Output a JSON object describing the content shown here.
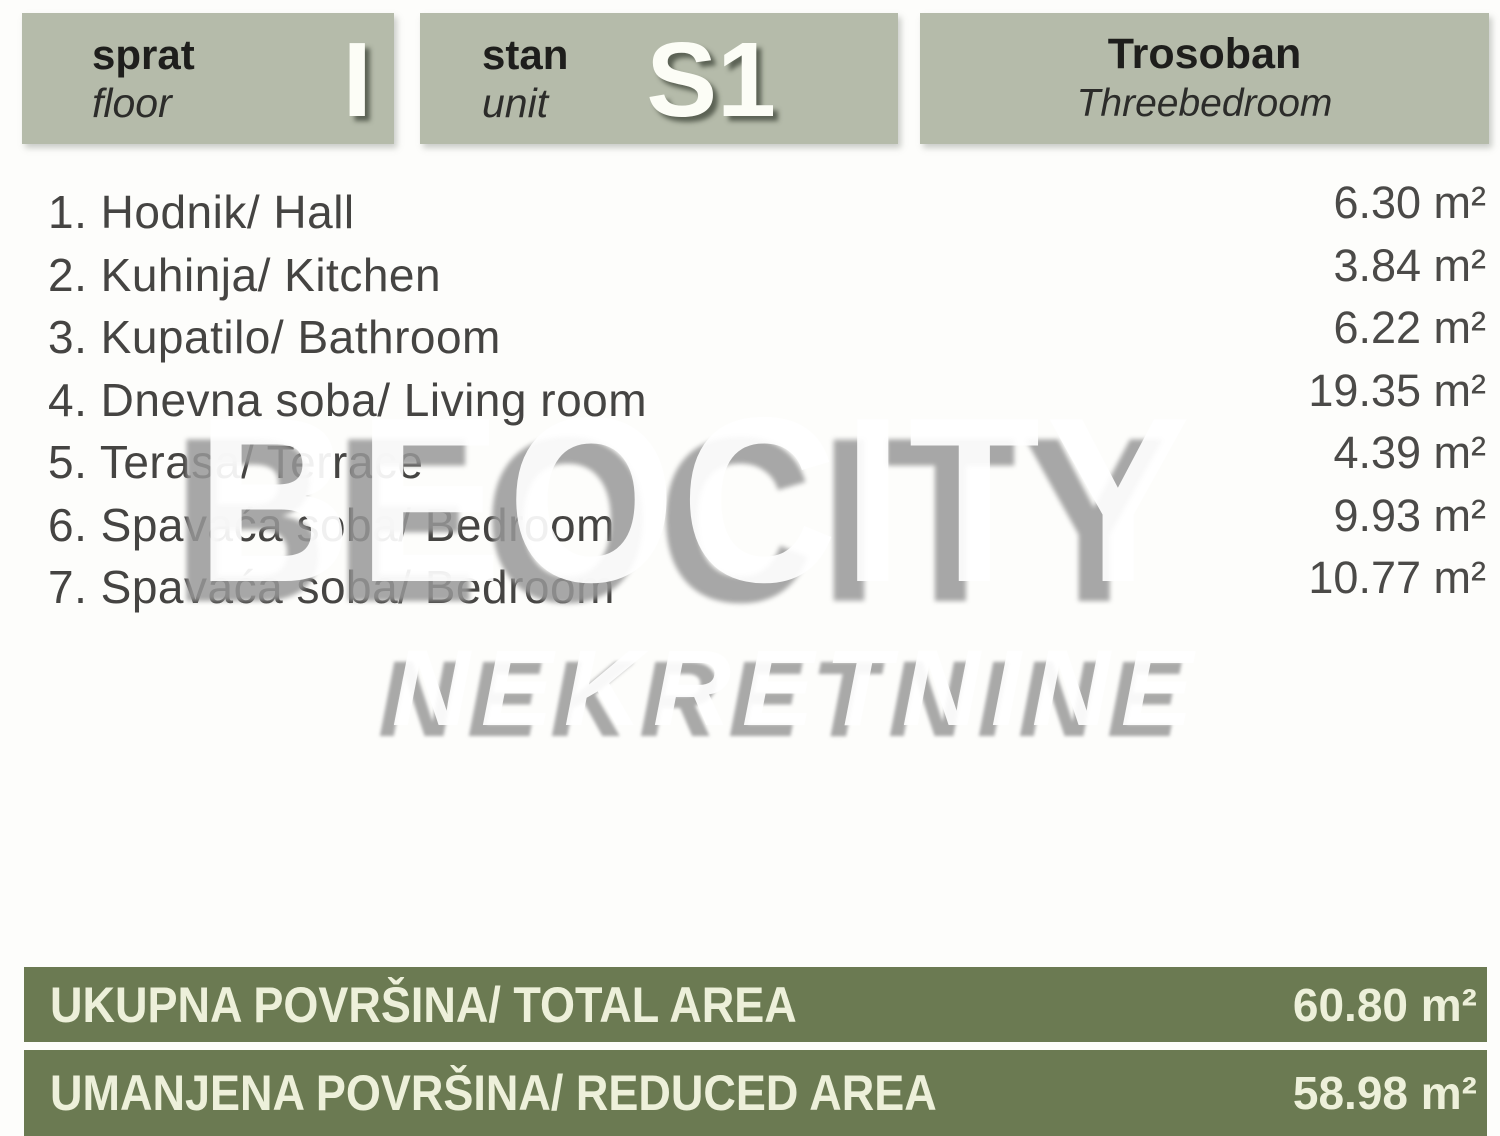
{
  "header": {
    "floor": {
      "label": "sprat",
      "sublabel": "floor",
      "value": "I"
    },
    "unit": {
      "label": "stan",
      "sublabel": "unit",
      "value": "S1"
    },
    "apartment_type": {
      "label": "Trosoban",
      "sublabel": "Threebedroom"
    }
  },
  "rooms": [
    {
      "label": "1. Hodnik/ Hall",
      "area": "6.30 m²"
    },
    {
      "label": "2. Kuhinja/ Kitchen",
      "area": "3.84 m²"
    },
    {
      "label": "3. Kupatilo/ Bathroom",
      "area": "6.22 m²"
    },
    {
      "label": "4. Dnevna soba/ Living room",
      "area": "19.35 m²"
    },
    {
      "label": "5. Terasa/ Terrace",
      "area": "4.39 m²"
    },
    {
      "label": "6. Spavaća soba/ Bedroom",
      "area": "9.93 m²"
    },
    {
      "label": "7. Spavaća soba/ Bedroom",
      "area": "10.77 m²"
    }
  ],
  "watermark": {
    "primary": "BEOCITY",
    "secondary": "NEKRETNINE"
  },
  "totals": {
    "total": {
      "label": "UKUPNA POVRŠINA/ TOTAL AREA",
      "value": "60.80 m²"
    },
    "reduced": {
      "label": "UMANJENA POVRŠINA/ REDUCED AREA",
      "value": "58.98 m²"
    }
  },
  "colors": {
    "header_bg": "#b5bbaa",
    "footer_bg": "#6b7a52",
    "footer_text": "#edf0da",
    "body_text": "#454442",
    "header_text": "#1e1e1c",
    "white_glyph": "#fcfdf6"
  }
}
